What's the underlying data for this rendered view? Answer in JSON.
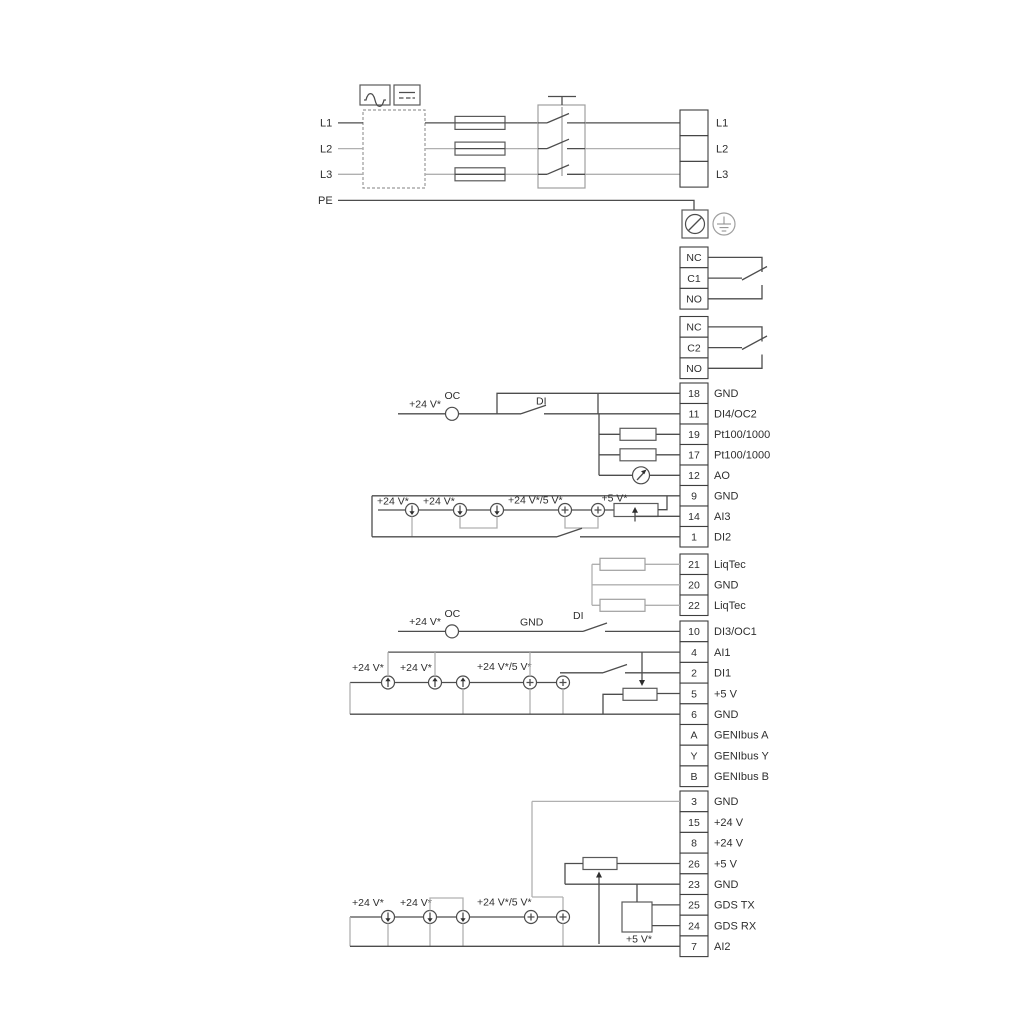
{
  "ann": {
    "v24": "+24 V*",
    "v24_5": "+24 V*/5 V*",
    "v5s": "+5 V*",
    "oc": "OC",
    "di": "DI",
    "gnd": "GND"
  },
  "power": {
    "in": [
      "L1",
      "L2",
      "L3",
      "PE"
    ],
    "out": [
      "L1",
      "L2",
      "L3"
    ]
  },
  "relay1": [
    "NC",
    "C1",
    "NO"
  ],
  "relay2": [
    "NC",
    "C2",
    "NO"
  ],
  "io1": [
    {
      "n": "18",
      "l": "GND"
    },
    {
      "n": "11",
      "l": "DI4/OC2"
    },
    {
      "n": "19",
      "l": "Pt100/1000"
    },
    {
      "n": "17",
      "l": "Pt100/1000"
    },
    {
      "n": "12",
      "l": "AO"
    },
    {
      "n": "9",
      "l": "GND"
    },
    {
      "n": "14",
      "l": "AI3"
    },
    {
      "n": "1",
      "l": "DI2"
    }
  ],
  "liq": [
    {
      "n": "21",
      "l": "LiqTec"
    },
    {
      "n": "20",
      "l": "GND"
    },
    {
      "n": "22",
      "l": "LiqTec"
    }
  ],
  "io2": [
    {
      "n": "10",
      "l": "DI3/OC1"
    },
    {
      "n": "4",
      "l": "AI1"
    },
    {
      "n": "2",
      "l": "DI1"
    },
    {
      "n": "5",
      "l": "+5 V"
    },
    {
      "n": "6",
      "l": "GND"
    },
    {
      "n": "A",
      "l": "GENIbus A"
    },
    {
      "n": "Y",
      "l": "GENIbus Y"
    },
    {
      "n": "B",
      "l": "GENIbus B"
    }
  ],
  "io3": [
    {
      "n": "3",
      "l": "GND"
    },
    {
      "n": "15",
      "l": "+24 V"
    },
    {
      "n": "8",
      "l": "+24 V"
    },
    {
      "n": "26",
      "l": "+5 V"
    },
    {
      "n": "23",
      "l": "GND"
    },
    {
      "n": "25",
      "l": "GDS TX"
    },
    {
      "n": "24",
      "l": "GDS RX"
    },
    {
      "n": "7",
      "l": "AI2"
    }
  ],
  "icons": {
    "filter_ac": "sine-wave-icon",
    "filter_dc": "dc-lines-icon",
    "pe_screw": "screw-terminal-icon",
    "pe_earth": "earth-ground-icon",
    "analog_out": "meter-icon",
    "source": "current-source-icon"
  }
}
